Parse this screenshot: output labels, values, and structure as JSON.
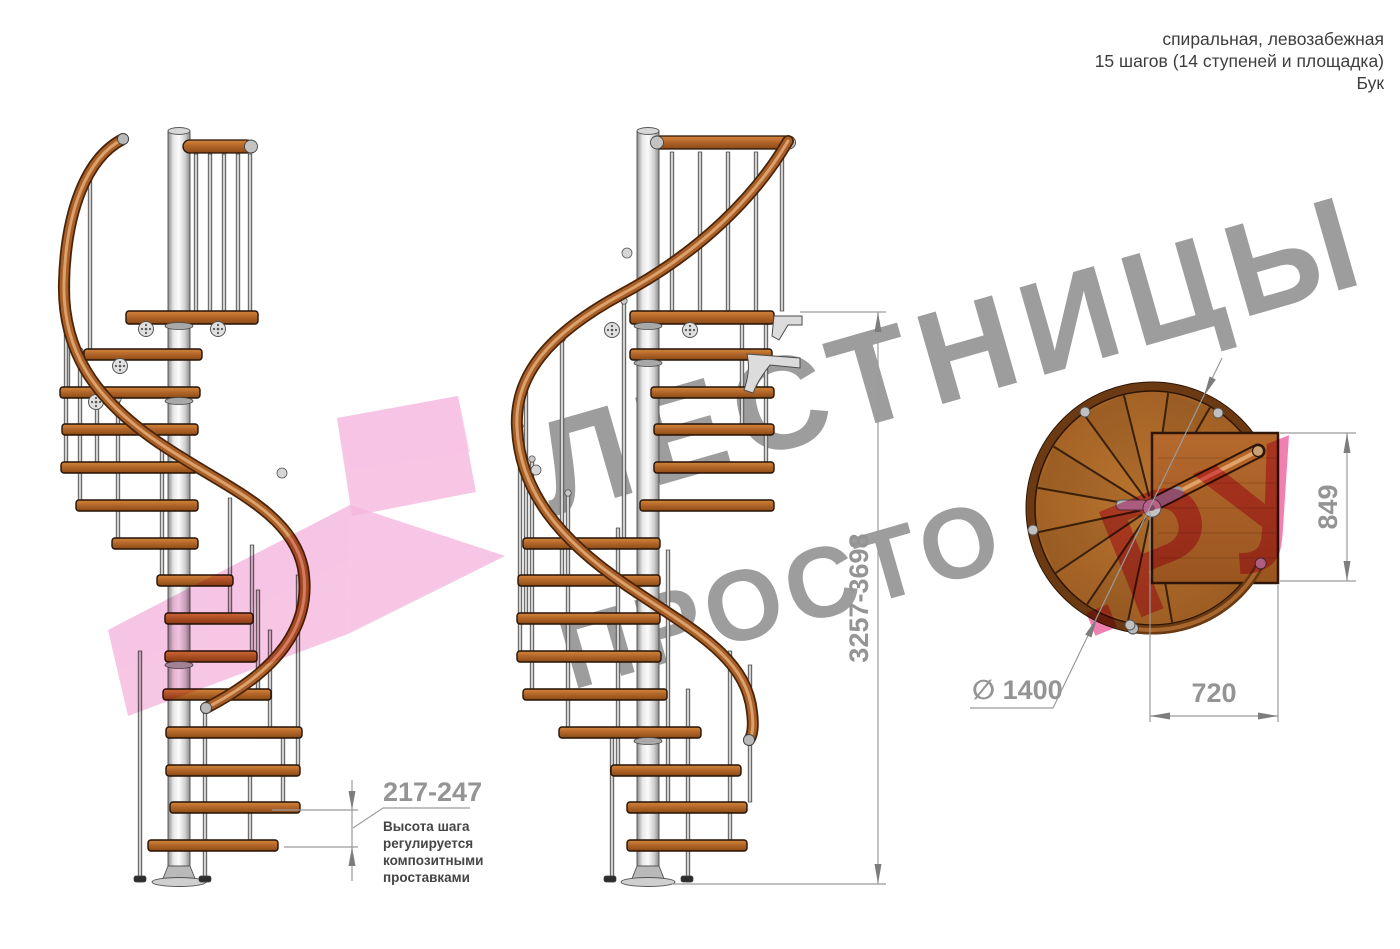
{
  "header": {
    "line1": "спиральная, левозабежная",
    "line2": "15 шагов (14 ступеней и площадка)",
    "line3": "Бук"
  },
  "watermark": {
    "word1": "ЛЕСТНИЦЫ",
    "word2": "ПРОСТО",
    "word3": ".РУ"
  },
  "dimensions": {
    "total_height": "3257-3698",
    "landing_side": "849",
    "diameter": "∅ 1400",
    "landing_depth": "720",
    "step_height": "217-247",
    "note": [
      "Высота шага",
      "регулируется",
      "композитными",
      "проставками"
    ]
  },
  "colors": {
    "wood": "#a9652c",
    "wood_dark": "#6b3a12",
    "handrail": "#a85f28",
    "metal": "#d9d9d9",
    "pink_arrow": "#f2a0d2",
    "pink_text": "#ef6fa8",
    "watermark_gray": "#9d9d9d",
    "dimension_gray": "#949494"
  }
}
